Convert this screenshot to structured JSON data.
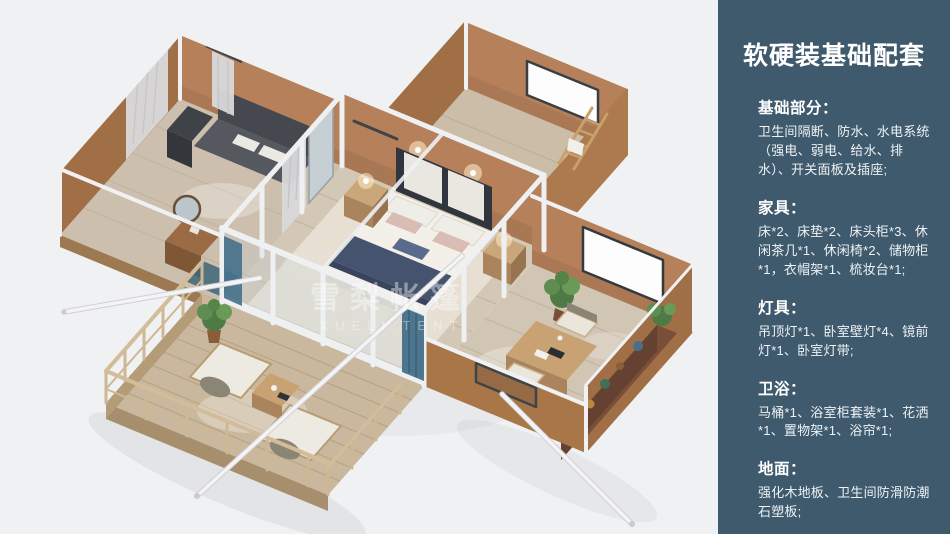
{
  "colors": {
    "sidebar_bg": "#3e5a6c",
    "canvas_bg": "#f0f1f2"
  },
  "render": {
    "watermark": {
      "line1": "雪梨帐篷",
      "line2": "XUELI TENT"
    }
  },
  "sidebar": {
    "title": "软硬装基础配套",
    "sections": [
      {
        "heading": "基础部分：",
        "body": "卫生间隔断、防水、水电系统（强电、弱电、给水、排水）、开关面板及插座;"
      },
      {
        "heading": "家具：",
        "body": "床*2、床垫*2、床头柜*3、休闲茶几*1、休闲椅*2、储物柜*1，衣帽架*1、梳妆台*1;"
      },
      {
        "heading": "灯具：",
        "body": "吊顶灯*1、卧室壁灯*4、镜前灯*1、卧室灯带;"
      },
      {
        "heading": "卫浴：",
        "body": "马桶*1、浴室柜套装*1、花洒*1、置物架*1、浴帘*1;"
      },
      {
        "heading": "地面：",
        "body": "强化木地板、卫生间防滑防潮石塑板;"
      }
    ]
  }
}
